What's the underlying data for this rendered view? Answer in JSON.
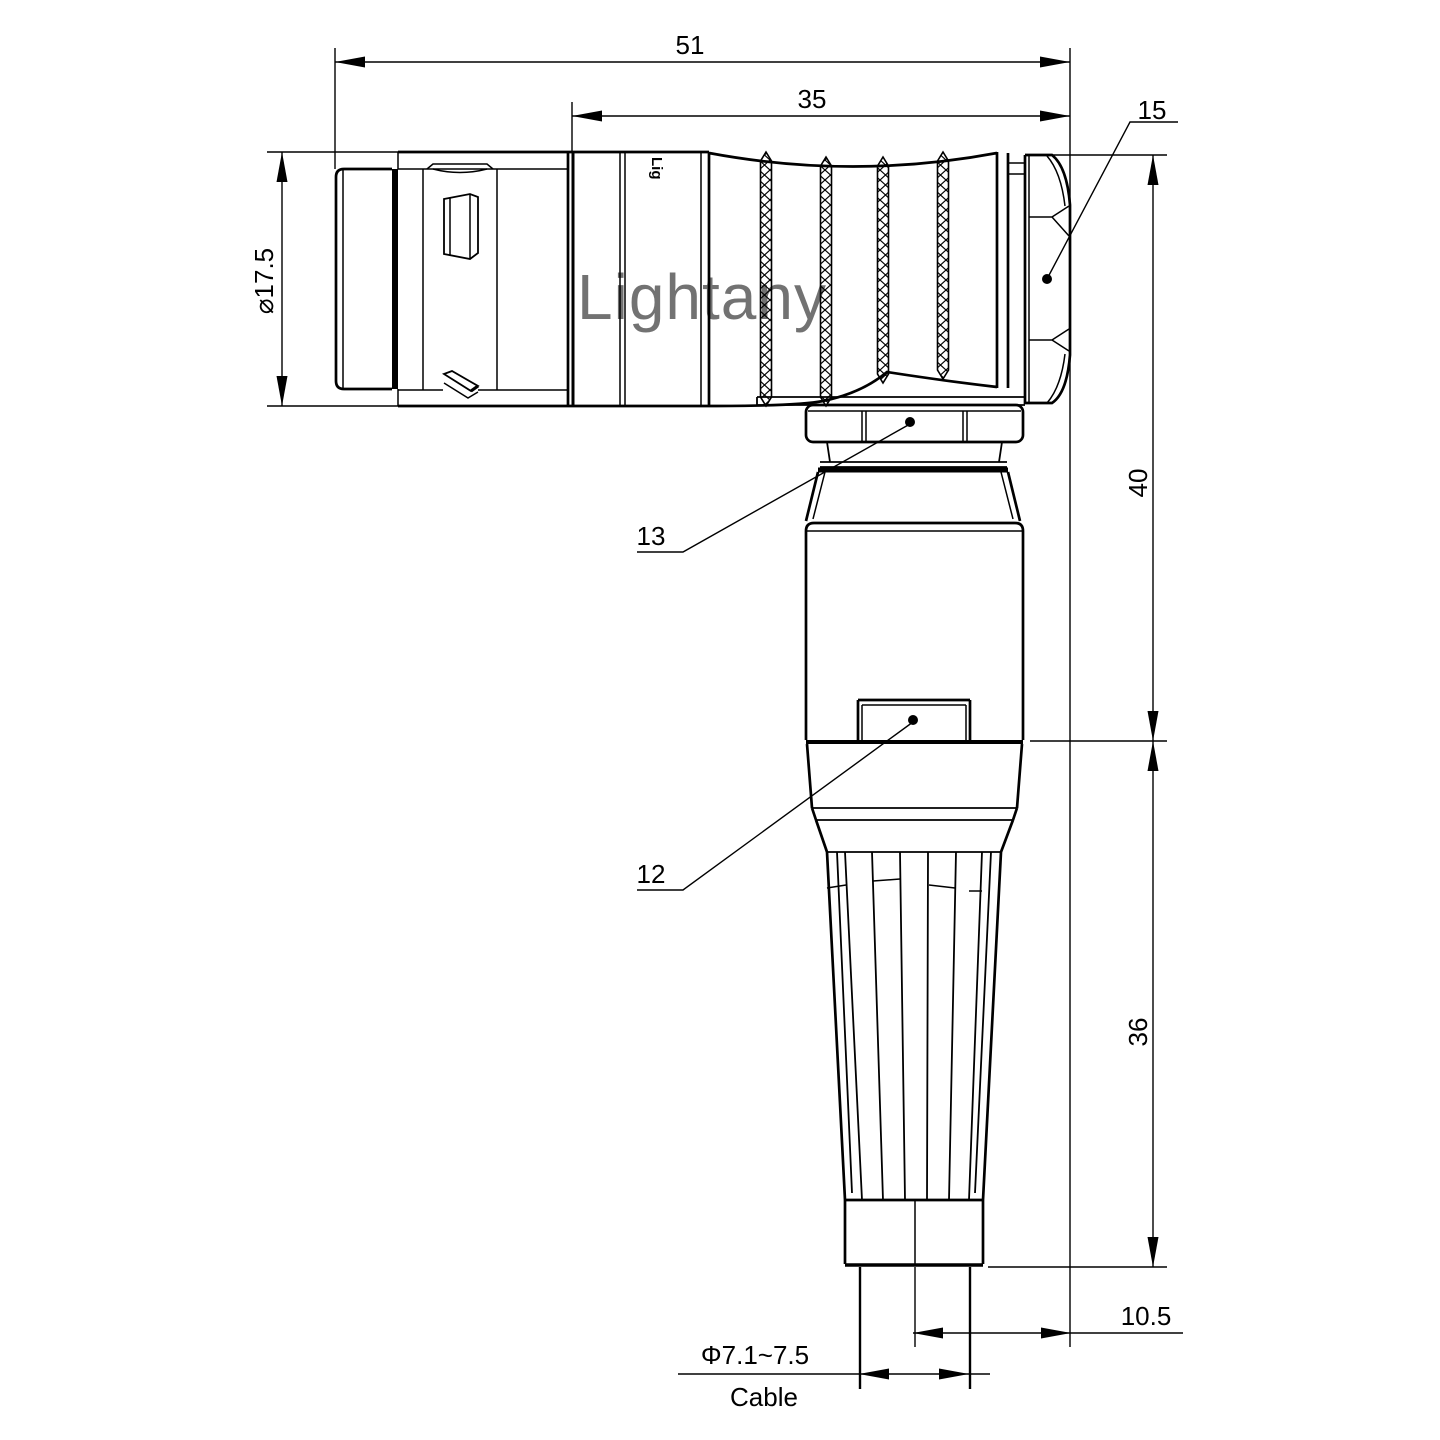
{
  "canvas": {
    "width": 1440,
    "height": 1440,
    "background": "#ffffff",
    "line_color": "#000000"
  },
  "watermark": {
    "text": "Lightany",
    "color": "#efc6c6"
  },
  "brand_stamp": "Lig",
  "labels": {
    "total_length": "51",
    "grip_length": "35",
    "hex_flat": "15",
    "shell_diameter": "⌀17.5",
    "coupling_nut": "13",
    "backshell_window": "12",
    "elbow_height": "40",
    "boot_length": "36",
    "cable_offset": "10.5",
    "cable_diameter": "Φ7.1~7.5",
    "cable_caption": "Cable"
  }
}
